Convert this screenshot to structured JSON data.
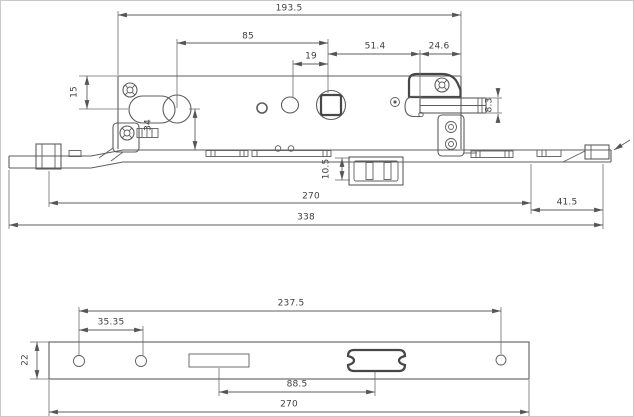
{
  "colors": {
    "background": "#ffffff",
    "line": "#5d5d5d",
    "text": "#3f3f3f"
  },
  "top_view": {
    "dimensions": {
      "overall_top": "193.5",
      "cylinder_to_follower": "85",
      "oval_to_follower": "19",
      "follower_to_hook": "51.4",
      "hook_to_edge": "24.6",
      "edge_to_cylinder": "15",
      "cylinder_to_rail": "34",
      "hook_bar_height": "8.3",
      "slider_height": "10.5",
      "rail_span": "270",
      "right_overhang": "41.5",
      "overall_length": "338"
    }
  },
  "bottom_view": {
    "dimensions": {
      "hole_span": "237.5",
      "hole_pitch": "35.35",
      "plate_width": "22",
      "slot_span": "88.5",
      "plate_length": "270"
    }
  }
}
